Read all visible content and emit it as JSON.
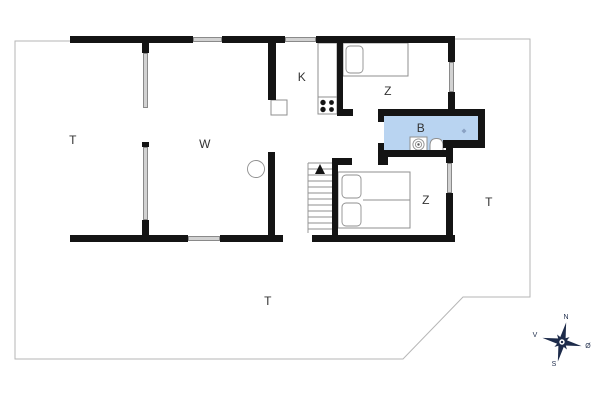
{
  "rooms": {
    "terrace_left": {
      "label": "T"
    },
    "living": {
      "label": "W"
    },
    "kitchen": {
      "label": "K"
    },
    "bedroom_top": {
      "label": "Z"
    },
    "bathroom": {
      "label": "B"
    },
    "bedroom_lower": {
      "label": "Z"
    },
    "terrace_right": {
      "label": "T"
    },
    "terrace_bottom": {
      "label": "T"
    }
  },
  "compass": {
    "north": "N",
    "south": "S",
    "east": "Ø",
    "west": "V"
  },
  "colors": {
    "wall": "#141414",
    "window_fill": "#d2d2d2",
    "window_border": "#8a8a8a",
    "bathroom_fill": "#b9d4f1",
    "boundary_line": "#b6b6b6",
    "furniture_line": "#8f8f8f",
    "compass": "#1d2b4a",
    "label_text": "#333333"
  }
}
